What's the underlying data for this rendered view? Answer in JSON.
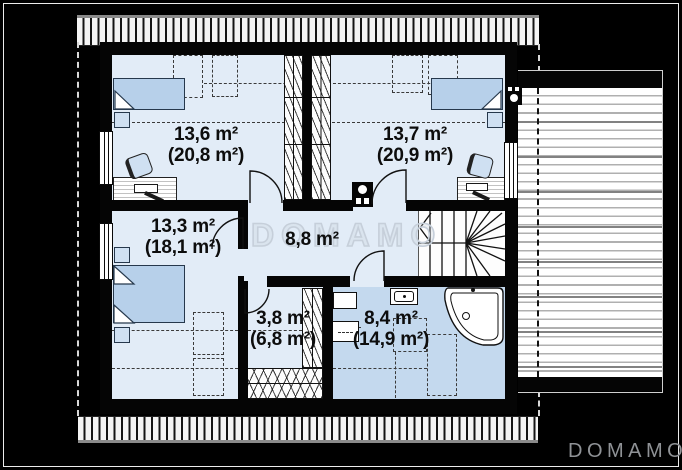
{
  "watermark": {
    "text": "DOMAMO"
  },
  "brand": {
    "logo_text": "DOMAMO"
  },
  "rooms": {
    "tl": {
      "name": "bedroom-top-left",
      "area": "13,6 m²",
      "area_total": "(20,8 m²)"
    },
    "tr": {
      "name": "bedroom-top-right",
      "area": "13,7 m²",
      "area_total": "(20,9 m²)"
    },
    "bl": {
      "name": "bedroom-bottom-left",
      "area": "13,3 m²",
      "area_total": "(18,1 m²)"
    },
    "hall": {
      "name": "hallway",
      "area": "8,8 m²"
    },
    "wardrobe": {
      "name": "walk-in-closet",
      "area": "3,8 m²",
      "area_total": "(6,8 m²)"
    },
    "bath": {
      "name": "bathroom",
      "area": "8,4 m²",
      "area_total": "(14,9 m²)"
    }
  },
  "colors": {
    "background": "#000000",
    "floor": "#e2ecf7",
    "bathroom_floor": "#c4d9ee",
    "furniture_fill": "#b7d0ea",
    "wall": "#000000",
    "watermark_outline": "#c6cfda",
    "logo_text": "#8f9296"
  }
}
